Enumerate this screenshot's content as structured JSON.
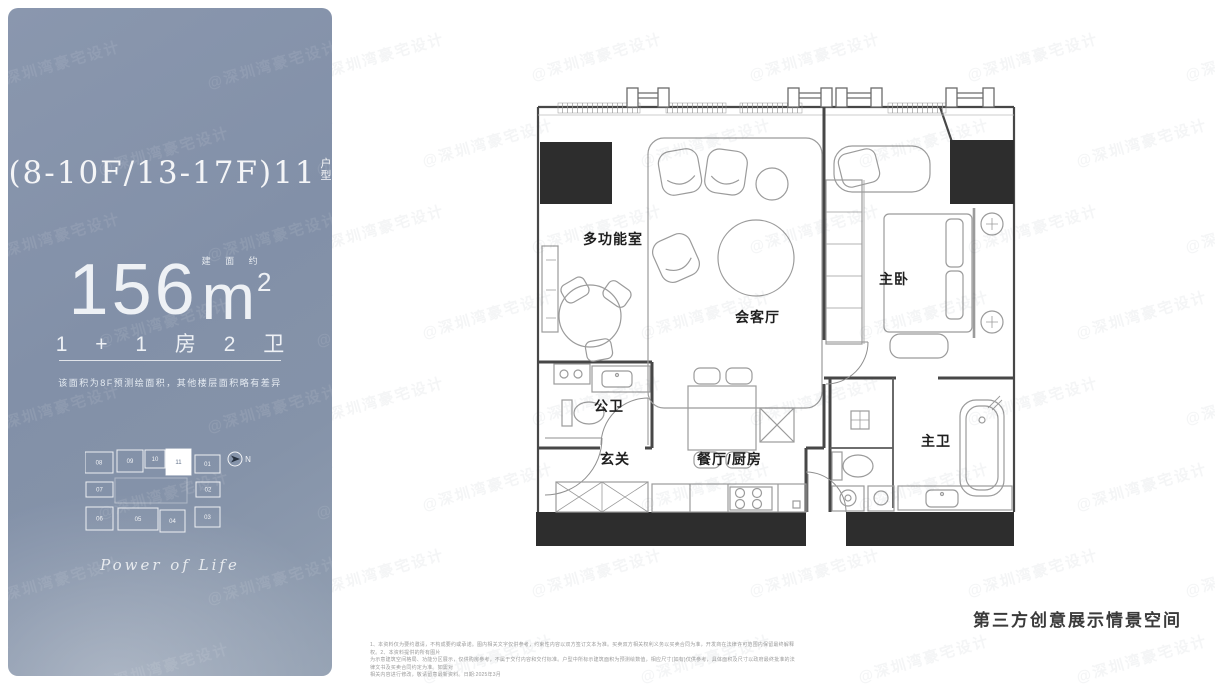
{
  "sidebar": {
    "unit_title": "(8-10F/13-17F)11",
    "unit_type_stack": [
      "户",
      "型"
    ],
    "area": {
      "prefix_small": "建 面 约",
      "value": "156",
      "unit": "m",
      "sup": "2"
    },
    "layout_text": "1 + 1 房 2 卫",
    "note": "该面积为8F预测绘面积，其他楼层面积略有差异",
    "keyplan": {
      "units": [
        "08",
        "09",
        "10",
        "11",
        "01",
        "07",
        "02",
        "06",
        "05",
        "04",
        "03"
      ],
      "highlighted_unit": "11",
      "north_label": "N"
    },
    "slogan": "Power of Life"
  },
  "plan": {
    "rooms": [
      {
        "label": "多功能室"
      },
      {
        "label": "会客厅"
      },
      {
        "label": "主卧"
      },
      {
        "label": "公卫"
      },
      {
        "label": "玄关"
      },
      {
        "label": "餐厅/厨房"
      },
      {
        "label": "主卫"
      }
    ]
  },
  "footer": {
    "caption": "第三方创意展示情景空间",
    "disclaimer_lines": [
      "1、本资料仅为要约邀请，不构成要约或承诺。图内相关文字仅供参考，约束性内容以双方签订文本为准。买卖双方相关权利义务以买卖合同为准，开发商在法律许可范围内保留最终解释权。2、本资料提供的所有图片",
      "为示意建筑空间格局、功能分区展示，仅供购房参考，不属于交付内容和交付标准。户型中所标示建筑面积为预测绘数值，相应尺寸(如有)仅供参考，具体面积及尺寸以政府最终批准的法律文书及买卖合同约定为准。如需对",
      "相关内容进行修改，敬请留意最新资料。日期:2025年3月"
    ]
  },
  "watermark": {
    "text": "@深圳湾豪宅设计"
  },
  "colors": {
    "sidebar_bg": "#8593a9",
    "structure_black": "#2d2d2d"
  }
}
